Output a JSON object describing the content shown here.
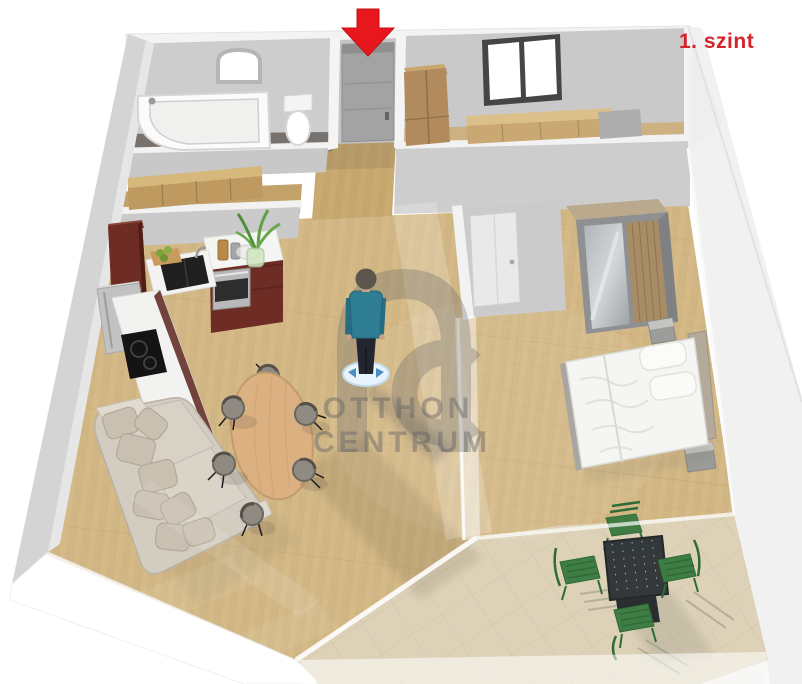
{
  "floor_label": {
    "text": "1. szint",
    "color": "#d6232a"
  },
  "watermark": {
    "logo_text": "OC",
    "line1": "OTTHON",
    "line2": "CENTRUM",
    "color": "#6a6a6a"
  },
  "entrance_arrow": {
    "icon": "red-down-arrow",
    "color": "#e8161d"
  },
  "palette": {
    "background": "#ffffff",
    "wall_top": "#f2f2f2",
    "wall_face": "#cdcdcd",
    "outer_wall": "#d4d4d4",
    "wood_floor": "#d5ba87",
    "hall_floor": "#c9ab72",
    "tile_floor": "#ddd2b8",
    "bathroom_floor": "#78726e",
    "kitchen_cabinet": "#6e2d24",
    "countertop": "#f3f3f1",
    "sofa": "#d3ccc1",
    "dining_table": "#dcb182",
    "chair_gray": "#8f8a82",
    "terrace_table": "#33383b",
    "terrace_chair_green": "#3f7d44",
    "person_shirt": "#2e7d92",
    "person_disc": "#e8f3fb",
    "bedding": "#f5f5f3",
    "wardrobe_wood": "#a78c66"
  }
}
